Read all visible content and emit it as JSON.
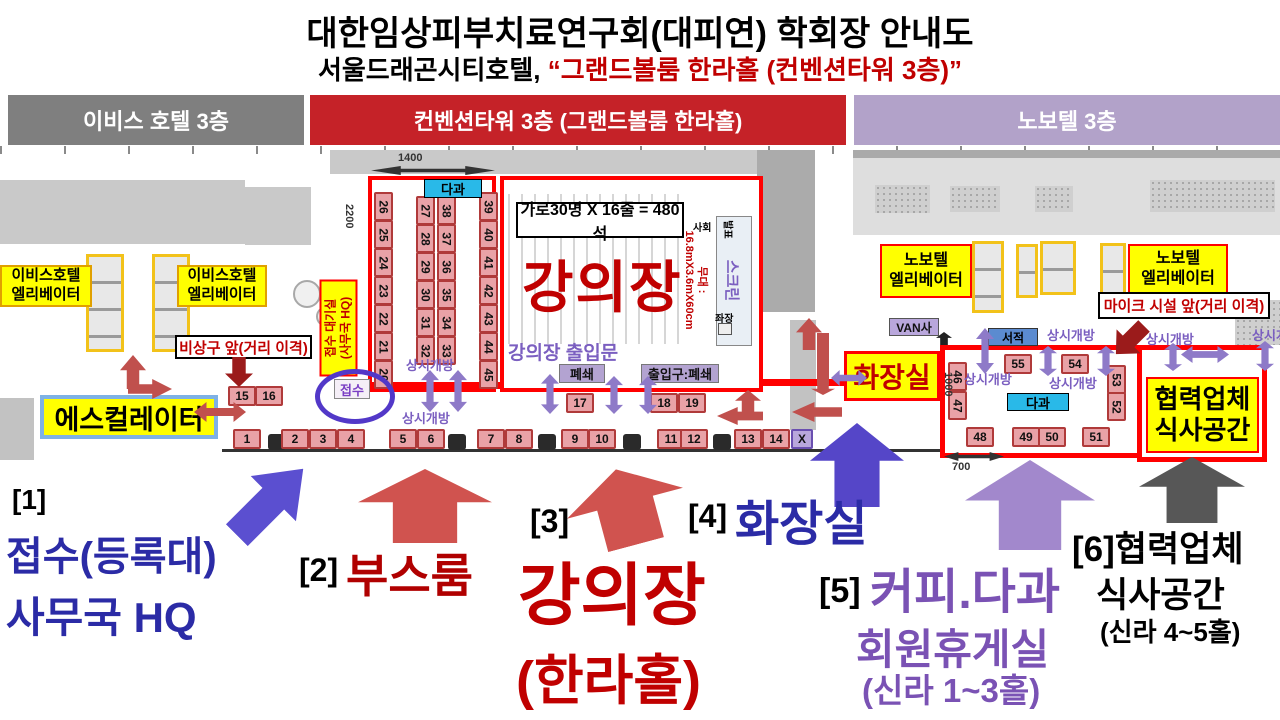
{
  "title": "대한임상피부치료연구회(대피연) 학회장 안내도",
  "subtitle": {
    "prefix": "서울드래곤시티호텔,",
    "highlight": "“그랜드볼룸 한라홀 (컨벤션타워 3층)”"
  },
  "floor_headers": {
    "ibis": "이비스 호텔 3층",
    "convention": "컨벤션타워 3층 (그랜드볼룸 한라홀)",
    "novotel": "노보텔 3층"
  },
  "plan": {
    "ibis_elevator": "이비스호텔\n엘리베이터",
    "novotel_elevator": "노보텔\n엘리베이터",
    "escalator": "에스컬레이터",
    "emergency_exit_note": "비상구 앞(거리 이격)",
    "mic_note": "마이크 시설 앞(거리 이격)",
    "reception_waiting": "접수 대기실\n(사무국 HQ)",
    "reception": "접수",
    "refreshments": "다과",
    "always_open": "상시개방",
    "books": "서적",
    "van": "VAN사",
    "restroom": "화장실",
    "partner_dining": "협력업체\n식사공간",
    "lecture_hall": "강의장",
    "capacity_note": "가로30명 X 16줄 = 480석",
    "hall_doors": "강의장 출입문",
    "stage": "무대 :\n16.8mX3.6mX60cm",
    "screen": "스크린",
    "presenter": "발표",
    "moderator": "사회",
    "session_chair": "좌장",
    "closed": "폐쇄",
    "entrance_closed": "출입구:폐쇄",
    "dims": {
      "w1400": "1400",
      "h2200": "2200",
      "w700": "700",
      "h1000": "1000"
    }
  },
  "booths": {
    "corridor_bottom": [
      "1",
      "2",
      "3",
      "4",
      "5",
      "6",
      "7",
      "8",
      "9",
      "10",
      "11",
      "12",
      "13",
      "14"
    ],
    "x_label": "X",
    "side_15_16": [
      "15",
      "16"
    ],
    "mid_17": "17",
    "pair_18_19": [
      "18",
      "19"
    ],
    "booth_room": {
      "left": [
        "26",
        "25",
        "24",
        "23",
        "22",
        "21",
        "20"
      ],
      "mid_a": [
        "27",
        "28",
        "29",
        "30",
        "31",
        "32"
      ],
      "mid_b": [
        "38",
        "37",
        "36",
        "35",
        "34",
        "33"
      ],
      "right": [
        "39",
        "40",
        "41",
        "42",
        "43",
        "44",
        "45"
      ]
    },
    "right_room": {
      "left": [
        "46",
        "47"
      ],
      "top": [
        "55",
        "54"
      ],
      "right": [
        "53",
        "52"
      ],
      "bottom": [
        "48",
        "49",
        "50",
        "51"
      ]
    }
  },
  "legend": {
    "item1_num": "[1]",
    "item1_line1": "접수(등록대)",
    "item1_line2": "사무국 HQ",
    "item2_num": "[2]",
    "item2_label": "부스룸",
    "item3_num": "[3]",
    "item3_label": "강의장",
    "item3_sub": "(한라홀)",
    "item4_num": "[4]",
    "item4_label": "화장실",
    "item5_num": "[5]",
    "item5_line1": "커피.다과",
    "item5_line2": "회원휴게실",
    "item5_line3": "(신라 1~3홀)",
    "item6_line1": "[6]협력업체",
    "item6_line2": "식사공간",
    "item6_line3": "(신라 4~5홀)"
  },
  "colors": {
    "header_gray": "#7F7F7F",
    "header_red": "#C52228",
    "header_purple": "#B2A2C9",
    "accent_red": "#C00000",
    "booth_fill": "#E9A2A7",
    "yellow": "#FFFF00",
    "cyan": "#29B9E8",
    "purple_text": "#7B5FC0",
    "legend_blue": "#2B2BA6",
    "legend_purple": "#7A52B4",
    "arrow_red": "#C0504D",
    "arrow_purple": "#8E7AC8",
    "arrow_blue_violet": "#5546C8",
    "arrow_gray": "#575757",
    "dark_red": "#9B1B1B"
  }
}
